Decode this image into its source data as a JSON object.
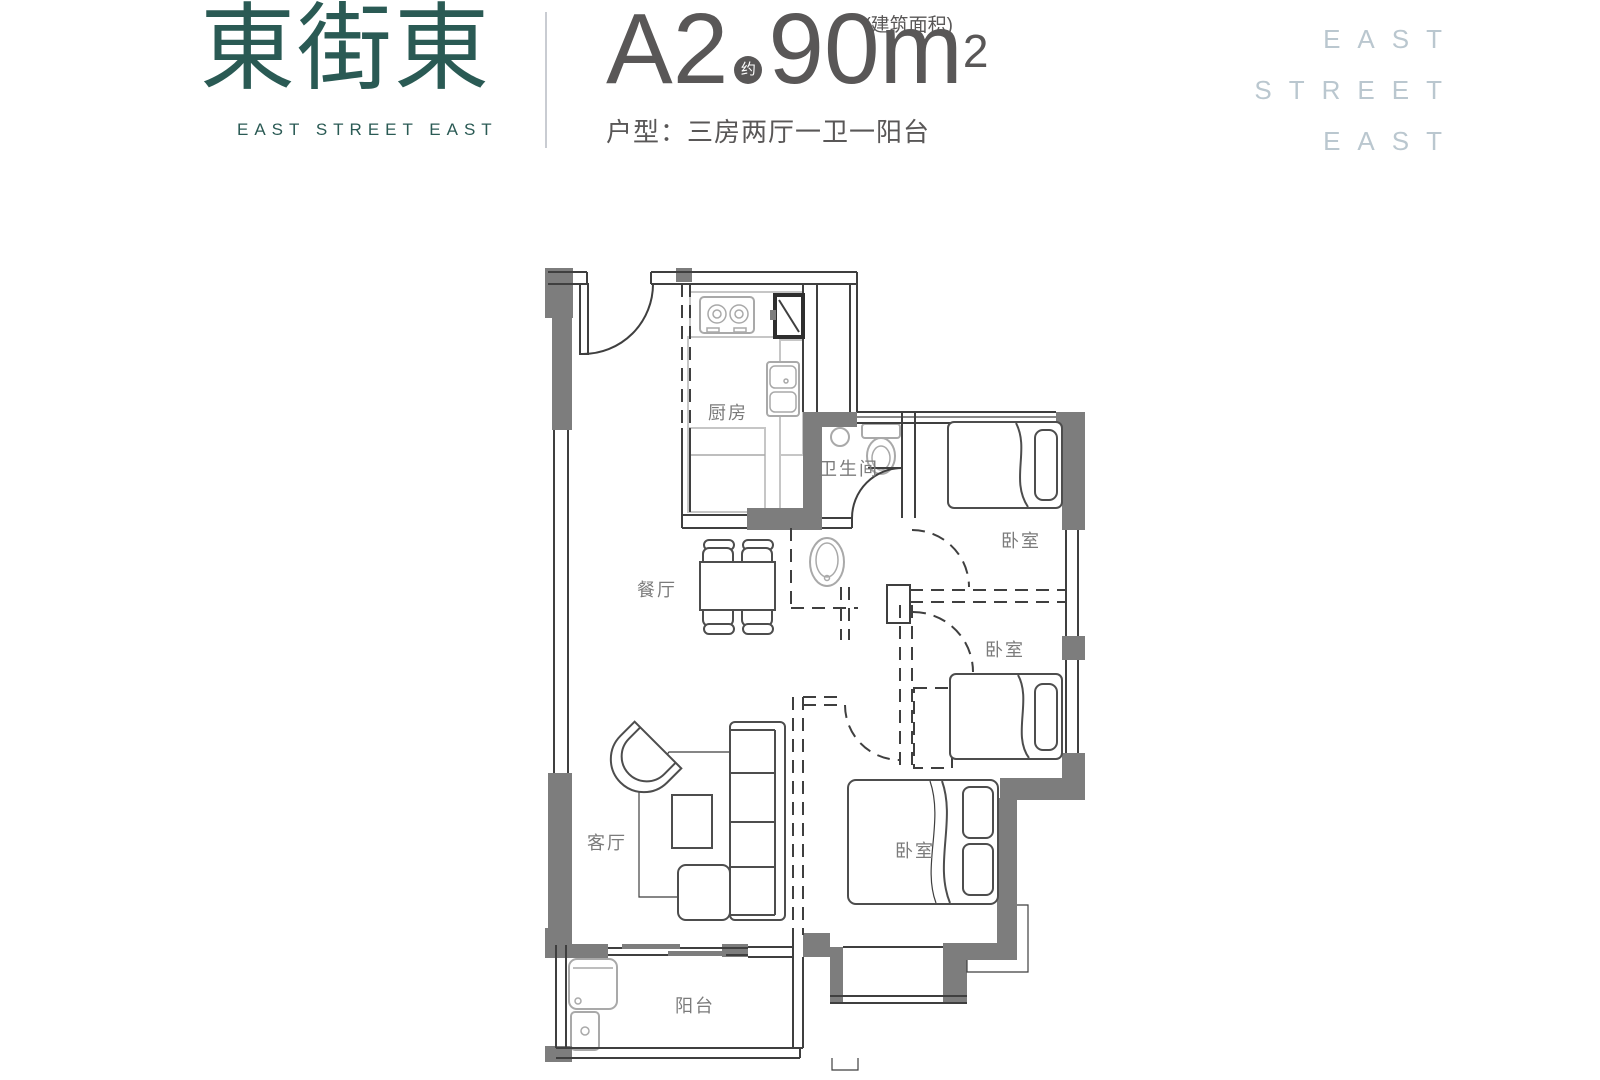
{
  "header": {
    "logo": {
      "cn": "東街東",
      "en": "EAST STREET EAST"
    },
    "title": {
      "unit_code": "A2",
      "approx_badge": "约",
      "area_value_unit": "90m",
      "area_exponent": "2",
      "area_note": "(建筑面积)"
    },
    "subtitle": "户型：三房两厅一卫一阳台",
    "watermark": [
      "EAST",
      "STREET",
      "EAST"
    ]
  },
  "floorplan": {
    "rooms": {
      "kitchen": "厨房",
      "bathroom": "卫生间",
      "bedroom_top": "卧室",
      "bedroom_middle": "卧室",
      "bedroom_master": "卧室",
      "dining": "餐厅",
      "living": "客厅",
      "balcony": "阳台"
    }
  },
  "colors": {
    "brand_teal": "#2a5a54",
    "title_gray": "#595757",
    "watermark_blue": "#bac7cf",
    "wall_gray": "#7d7d7d",
    "line_dark": "#3f3f3f",
    "label_gray": "#7b7b7b"
  }
}
